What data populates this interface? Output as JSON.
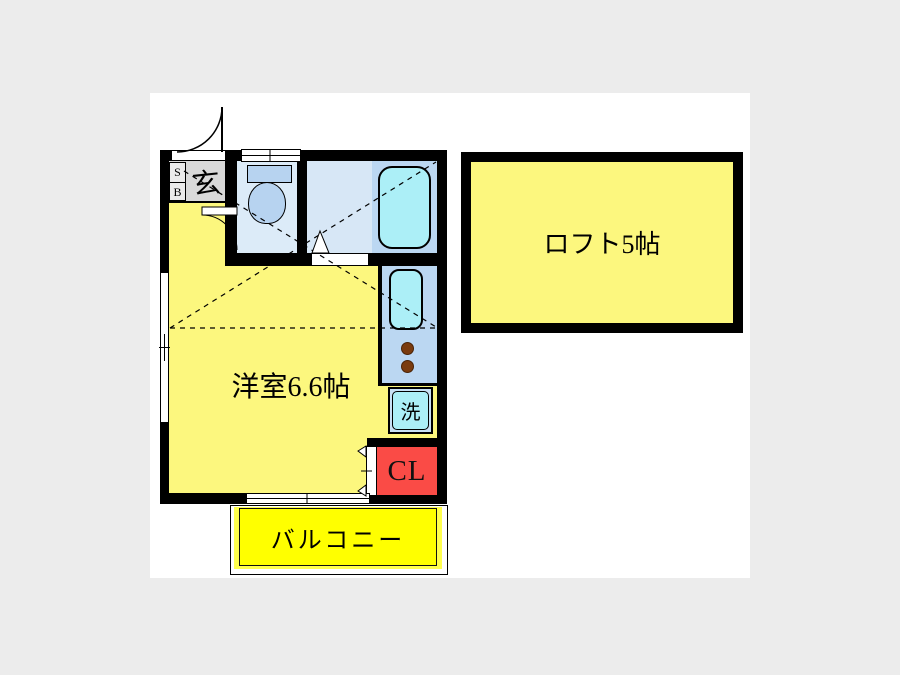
{
  "floorplan": {
    "rooms": {
      "main_room": {
        "label": "洋室6.6帖"
      },
      "loft": {
        "label": "ロフト5帖"
      },
      "balcony": {
        "label": "バルコニー"
      },
      "entrance": {
        "label": "玄"
      },
      "shoe_box": {
        "line1": "S",
        "line2": "B"
      },
      "washer": {
        "label": "洗"
      },
      "closet": {
        "label": "CL"
      }
    },
    "colors": {
      "room_yellow": "#FCF77E",
      "balcony_yellow": "#FFFF00",
      "water_room_light": "#DCEBF8",
      "water_room_medium": "#BBD7F2",
      "fixture_cyan": "#ACEFF7",
      "fixture_blue": "#B7D3F0",
      "closet_red": "#FA4B46",
      "entrance_gray": "#D9D9D9",
      "burner_brown": "#7A3B0E",
      "wall_black": "#000000"
    }
  }
}
